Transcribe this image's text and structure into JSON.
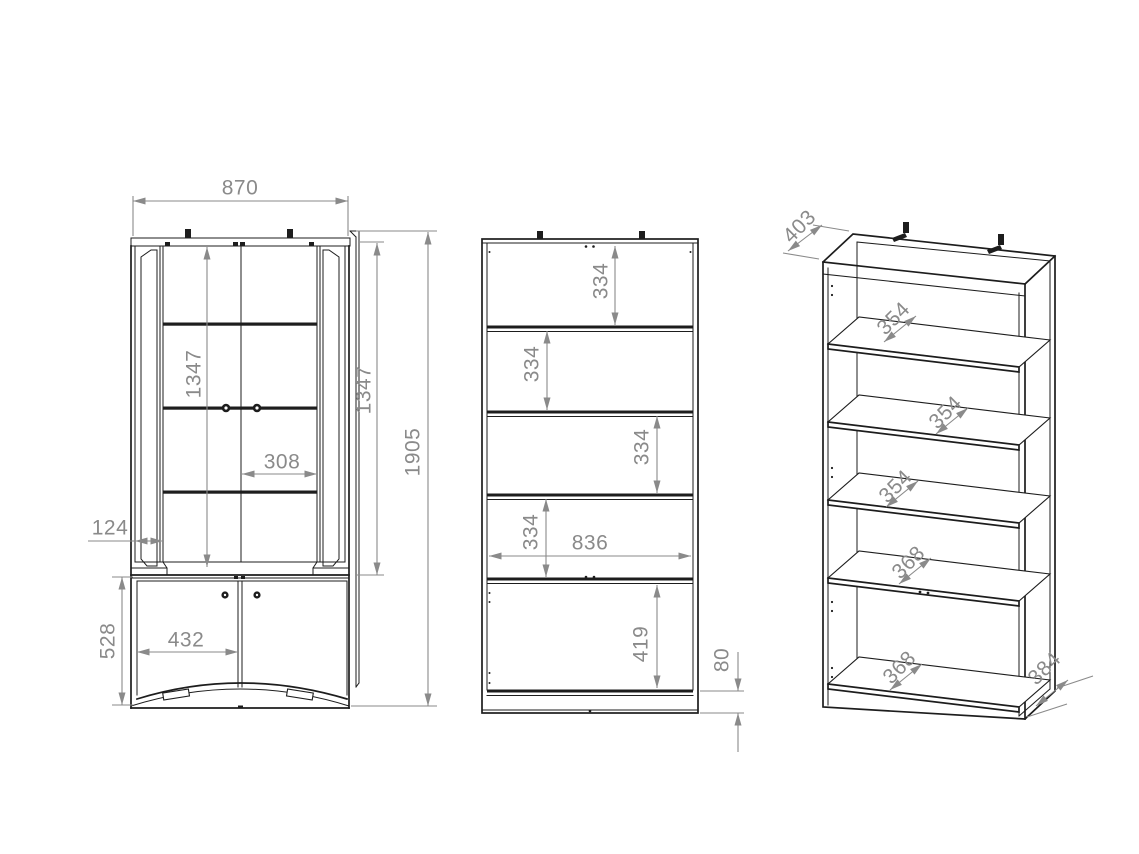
{
  "drawing": {
    "kind": "furniture dimension drawing",
    "colors": {
      "background": "#ffffff",
      "line": "#1d1d1d",
      "dimension": "#8a8a8a"
    },
    "views": {
      "front_doors": {
        "label": "front view with doors",
        "dims": {
          "overall_width": "870",
          "glass_door_height_left": "1347",
          "glass_door_height_right": "1347",
          "overall_height": "1905",
          "glass_door_width": "308",
          "side_frame_width": "124",
          "lower_door_height": "528",
          "lower_door_width": "432"
        }
      },
      "front_open": {
        "label": "front view open carcass",
        "shelf_gaps": [
          "334",
          "334",
          "334",
          "334"
        ],
        "dims": {
          "interior_width": "836",
          "bottom_compartment_height": "419",
          "plinth_height": "80"
        }
      },
      "isometric": {
        "label": "isometric view",
        "dims": {
          "top_depth": "403",
          "base_depth": "384"
        },
        "shelf_depths": [
          "354",
          "354",
          "354"
        ],
        "lower_shelf_depths": [
          "368",
          "368"
        ]
      }
    }
  }
}
